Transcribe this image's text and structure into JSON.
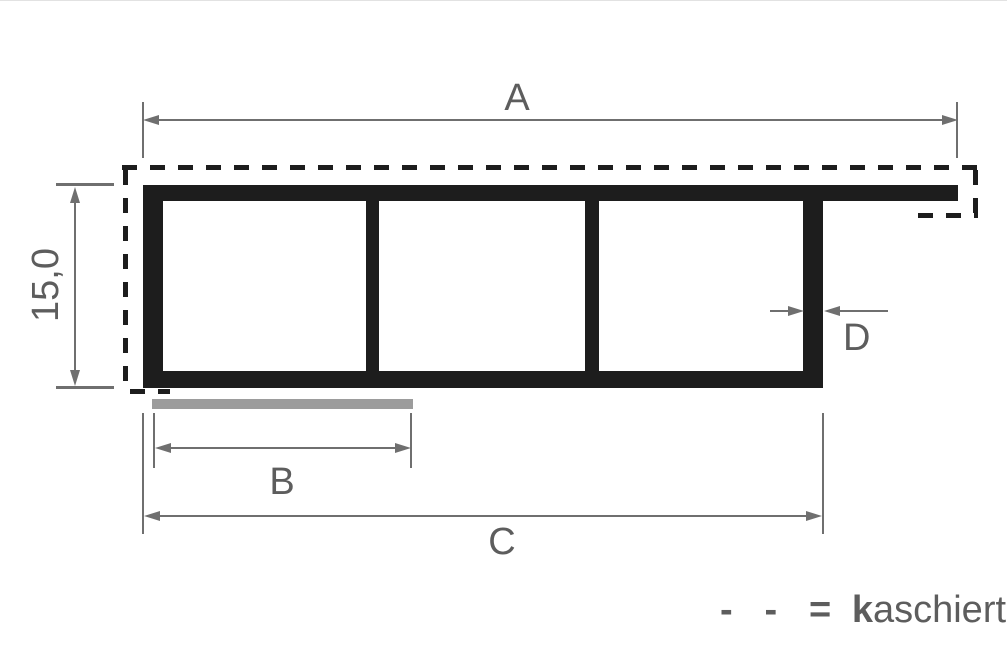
{
  "drawing": {
    "labels": {
      "a": "A",
      "b": "B",
      "c": "C",
      "d": "D",
      "height": "15,0"
    },
    "legend": {
      "symbol": "- - =",
      "term_bold": "k",
      "term_rest": "aschiert"
    },
    "colors": {
      "ink": "#1d1d1d",
      "dim": "#6f6f6f",
      "strip": "#9c9c9c",
      "text": "#5d5d5d"
    }
  }
}
